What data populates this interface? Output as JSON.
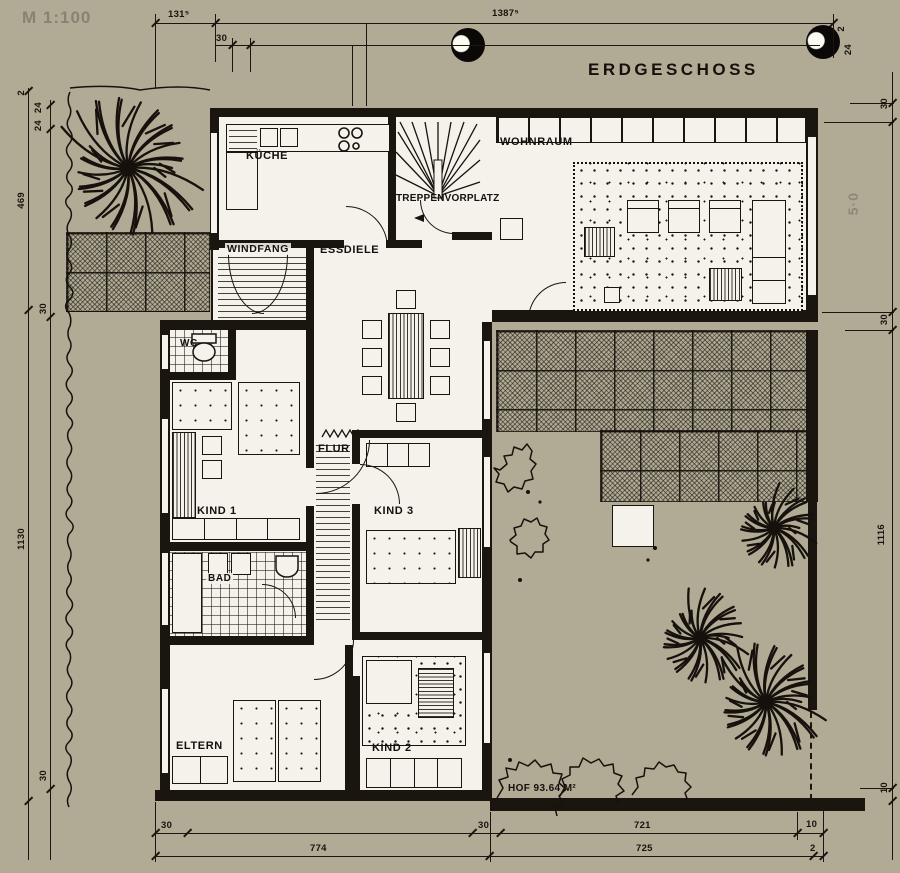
{
  "colors": {
    "paper": "#b1ab95",
    "ink": "#1a150f",
    "room_fill": "#f4f2ea",
    "pencil": "#615d52"
  },
  "title": {
    "plan": "ERDGESCHOSS",
    "scale_note": "M 1:100"
  },
  "rooms": {
    "kueche": "KÜCHE",
    "treppenvorplatz": "TREPPENVORPLATZ",
    "wohnraum": "WOHNRAUM",
    "windfang": "WINDFANG",
    "essdiele": "ESSDIELE",
    "wc": "WC",
    "flur": "FLUR",
    "kind1": "KIND 1",
    "kind3": "KIND 3",
    "bad": "BAD",
    "eltern": "ELTERN",
    "kind2": "KIND 2",
    "hof": "HOF  93.64 M²"
  },
  "dims": {
    "a1315": "131⁵",
    "a13875": "1387⁵",
    "d30": "30",
    "d2": "2",
    "d24": "24",
    "l469": "469",
    "l1130": "1130",
    "r1116": "1116",
    "r10": "10",
    "b721": "721",
    "b774": "774",
    "b725": "725",
    "b2": "2",
    "pencil50": "5·0"
  },
  "bleedthrough": {
    "f1": "n diesen Pre",
    "f2": "uch für Sie bereit",
    "f3": "besuchen Sie uns",
    "f4": "freundlicher Empfehlung",
    "f5": "baugesellschaft mbH & Co"
  }
}
